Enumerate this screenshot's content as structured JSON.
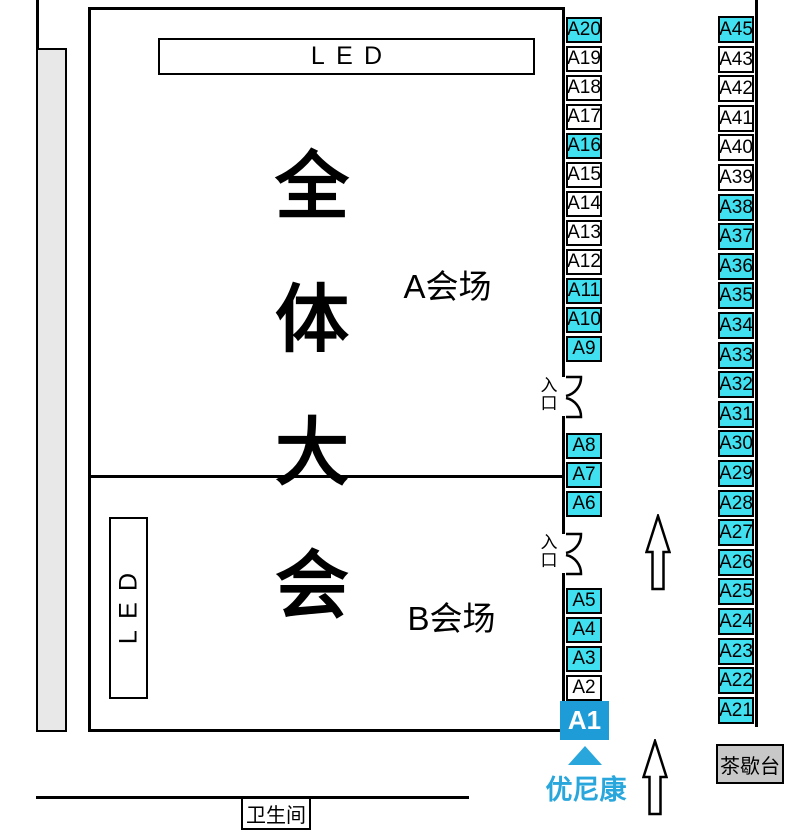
{
  "colors": {
    "booth_highlight": "#40E0F0",
    "booth_default": "#FFFFFF",
    "a1_fill": "#1E9CD7",
    "accent_text": "#29A7DC",
    "side_bar": "#E8E8E8",
    "tea_station_bg": "#C8C8C8",
    "line": "#000000"
  },
  "screens": {
    "top_led": "LED",
    "side_led": "LED"
  },
  "hall": {
    "title": "全体大会",
    "title_chars": [
      "全",
      "体",
      "大",
      "会"
    ],
    "hall_a_label": "A会场",
    "hall_b_label": "B会场"
  },
  "doors": {
    "entrance_label": "入口",
    "entrance_chars": [
      "入",
      "口"
    ]
  },
  "booths": {
    "left_groups": [
      [
        {
          "label": "A20",
          "highlight": true
        },
        {
          "label": "A19",
          "highlight": false
        },
        {
          "label": "A18",
          "highlight": false
        },
        {
          "label": "A17",
          "highlight": false
        },
        {
          "label": "A16",
          "highlight": true
        },
        {
          "label": "A15",
          "highlight": false
        },
        {
          "label": "A14",
          "highlight": false
        },
        {
          "label": "A13",
          "highlight": false
        },
        {
          "label": "A12",
          "highlight": false
        },
        {
          "label": "A11",
          "highlight": true
        },
        {
          "label": "A10",
          "highlight": true
        },
        {
          "label": "A9",
          "highlight": true
        }
      ],
      [
        {
          "label": "A8",
          "highlight": true
        },
        {
          "label": "A7",
          "highlight": true
        },
        {
          "label": "A6",
          "highlight": true
        }
      ],
      [
        {
          "label": "A5",
          "highlight": true
        },
        {
          "label": "A4",
          "highlight": true
        },
        {
          "label": "A3",
          "highlight": true
        },
        {
          "label": "A2",
          "highlight": false
        }
      ]
    ],
    "right": [
      {
        "label": "A45",
        "highlight": true
      },
      {
        "label": "A43",
        "highlight": false
      },
      {
        "label": "A42",
        "highlight": false
      },
      {
        "label": "A41",
        "highlight": false
      },
      {
        "label": "A40",
        "highlight": false
      },
      {
        "label": "A39",
        "highlight": false
      },
      {
        "label": "A38",
        "highlight": true
      },
      {
        "label": "A37",
        "highlight": true
      },
      {
        "label": "A36",
        "highlight": true
      },
      {
        "label": "A35",
        "highlight": true
      },
      {
        "label": "A34",
        "highlight": true
      },
      {
        "label": "A33",
        "highlight": true
      },
      {
        "label": "A32",
        "highlight": true
      },
      {
        "label": "A31",
        "highlight": true
      },
      {
        "label": "A30",
        "highlight": true
      },
      {
        "label": "A29",
        "highlight": true
      },
      {
        "label": "A28",
        "highlight": true
      },
      {
        "label": "A27",
        "highlight": true
      },
      {
        "label": "A26",
        "highlight": true
      },
      {
        "label": "A25",
        "highlight": true
      },
      {
        "label": "A24",
        "highlight": true
      },
      {
        "label": "A23",
        "highlight": true
      },
      {
        "label": "A22",
        "highlight": true
      },
      {
        "label": "A21",
        "highlight": true
      }
    ]
  },
  "featured_booth": {
    "label": "A1",
    "company": "优尼康"
  },
  "tea_station": {
    "label": "茶歇台"
  },
  "restroom": {
    "label": "卫生间"
  }
}
